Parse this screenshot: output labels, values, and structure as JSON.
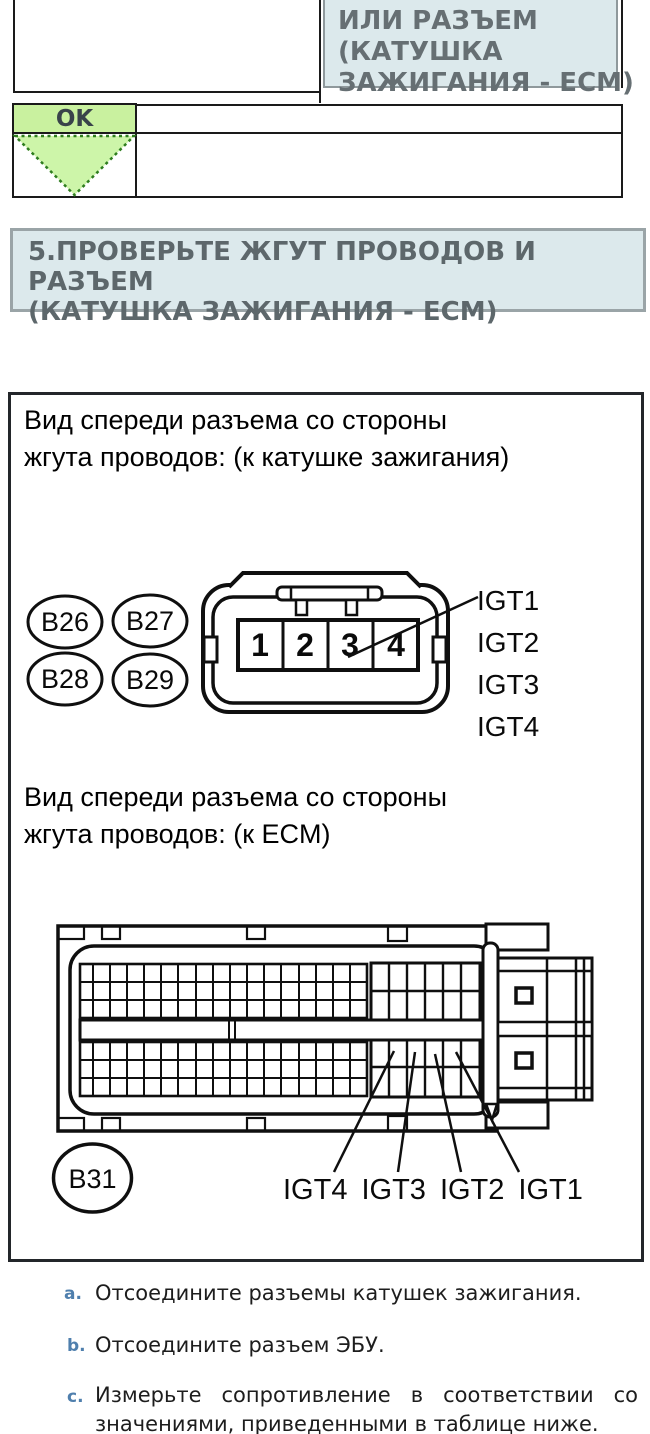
{
  "flow_table": {
    "or_cell_lines": [
      "ИЛИ РАЗЪЕМ",
      "(КАТУШКА",
      "ЗАЖИГАНИЯ - ECM)"
    ],
    "ok_label": "OK"
  },
  "step_heading_lines": [
    "5.ПРОВЕРЬТЕ ЖГУТ ПРОВОДОВ И РАЗЪЕМ",
    "(КАТУШКА ЗАЖИГАНИЯ - ECM)"
  ],
  "figure": {
    "caption_coil_lines": [
      "Вид спереди разъема со стороны",
      "жгута проводов: (к катушке зажигания)"
    ],
    "caption_ecm_lines": [
      "Вид спереди разъема со стороны",
      "жгута проводов: (к ECM)"
    ],
    "coil_connector": {
      "tags": [
        "B26",
        "B27",
        "B28",
        "B29"
      ],
      "pins": [
        "1",
        "2",
        "3",
        "4"
      ],
      "signals": [
        "IGT1",
        "IGT2",
        "IGT3",
        "IGT4"
      ]
    },
    "ecm_connector": {
      "tag": "B31",
      "signals": [
        "IGT4",
        "IGT3",
        "IGT2",
        "IGT1"
      ]
    }
  },
  "instructions": [
    {
      "marker": "a.",
      "lines": [
        "Отсоедините разъемы катушек зажигания.",
        ""
      ]
    },
    {
      "marker": "b.",
      "lines": [
        "Отсоедините разъем ЭБУ.",
        ""
      ]
    },
    {
      "marker": "c.",
      "lines": [
        "Измерьте сопротивление в соответствии со",
        "значениями, приведенными в таблице ниже."
      ]
    }
  ],
  "colors": {
    "ok_green": "#c9f19f",
    "triangle_green": "#cdf5a9",
    "triangle_border_green": "#2e7d1e",
    "panel_blue": "#dce9ec",
    "heading_text": "#5d676b",
    "marker_blue": "#4f7fad",
    "line_black": "#1a1a1a"
  }
}
